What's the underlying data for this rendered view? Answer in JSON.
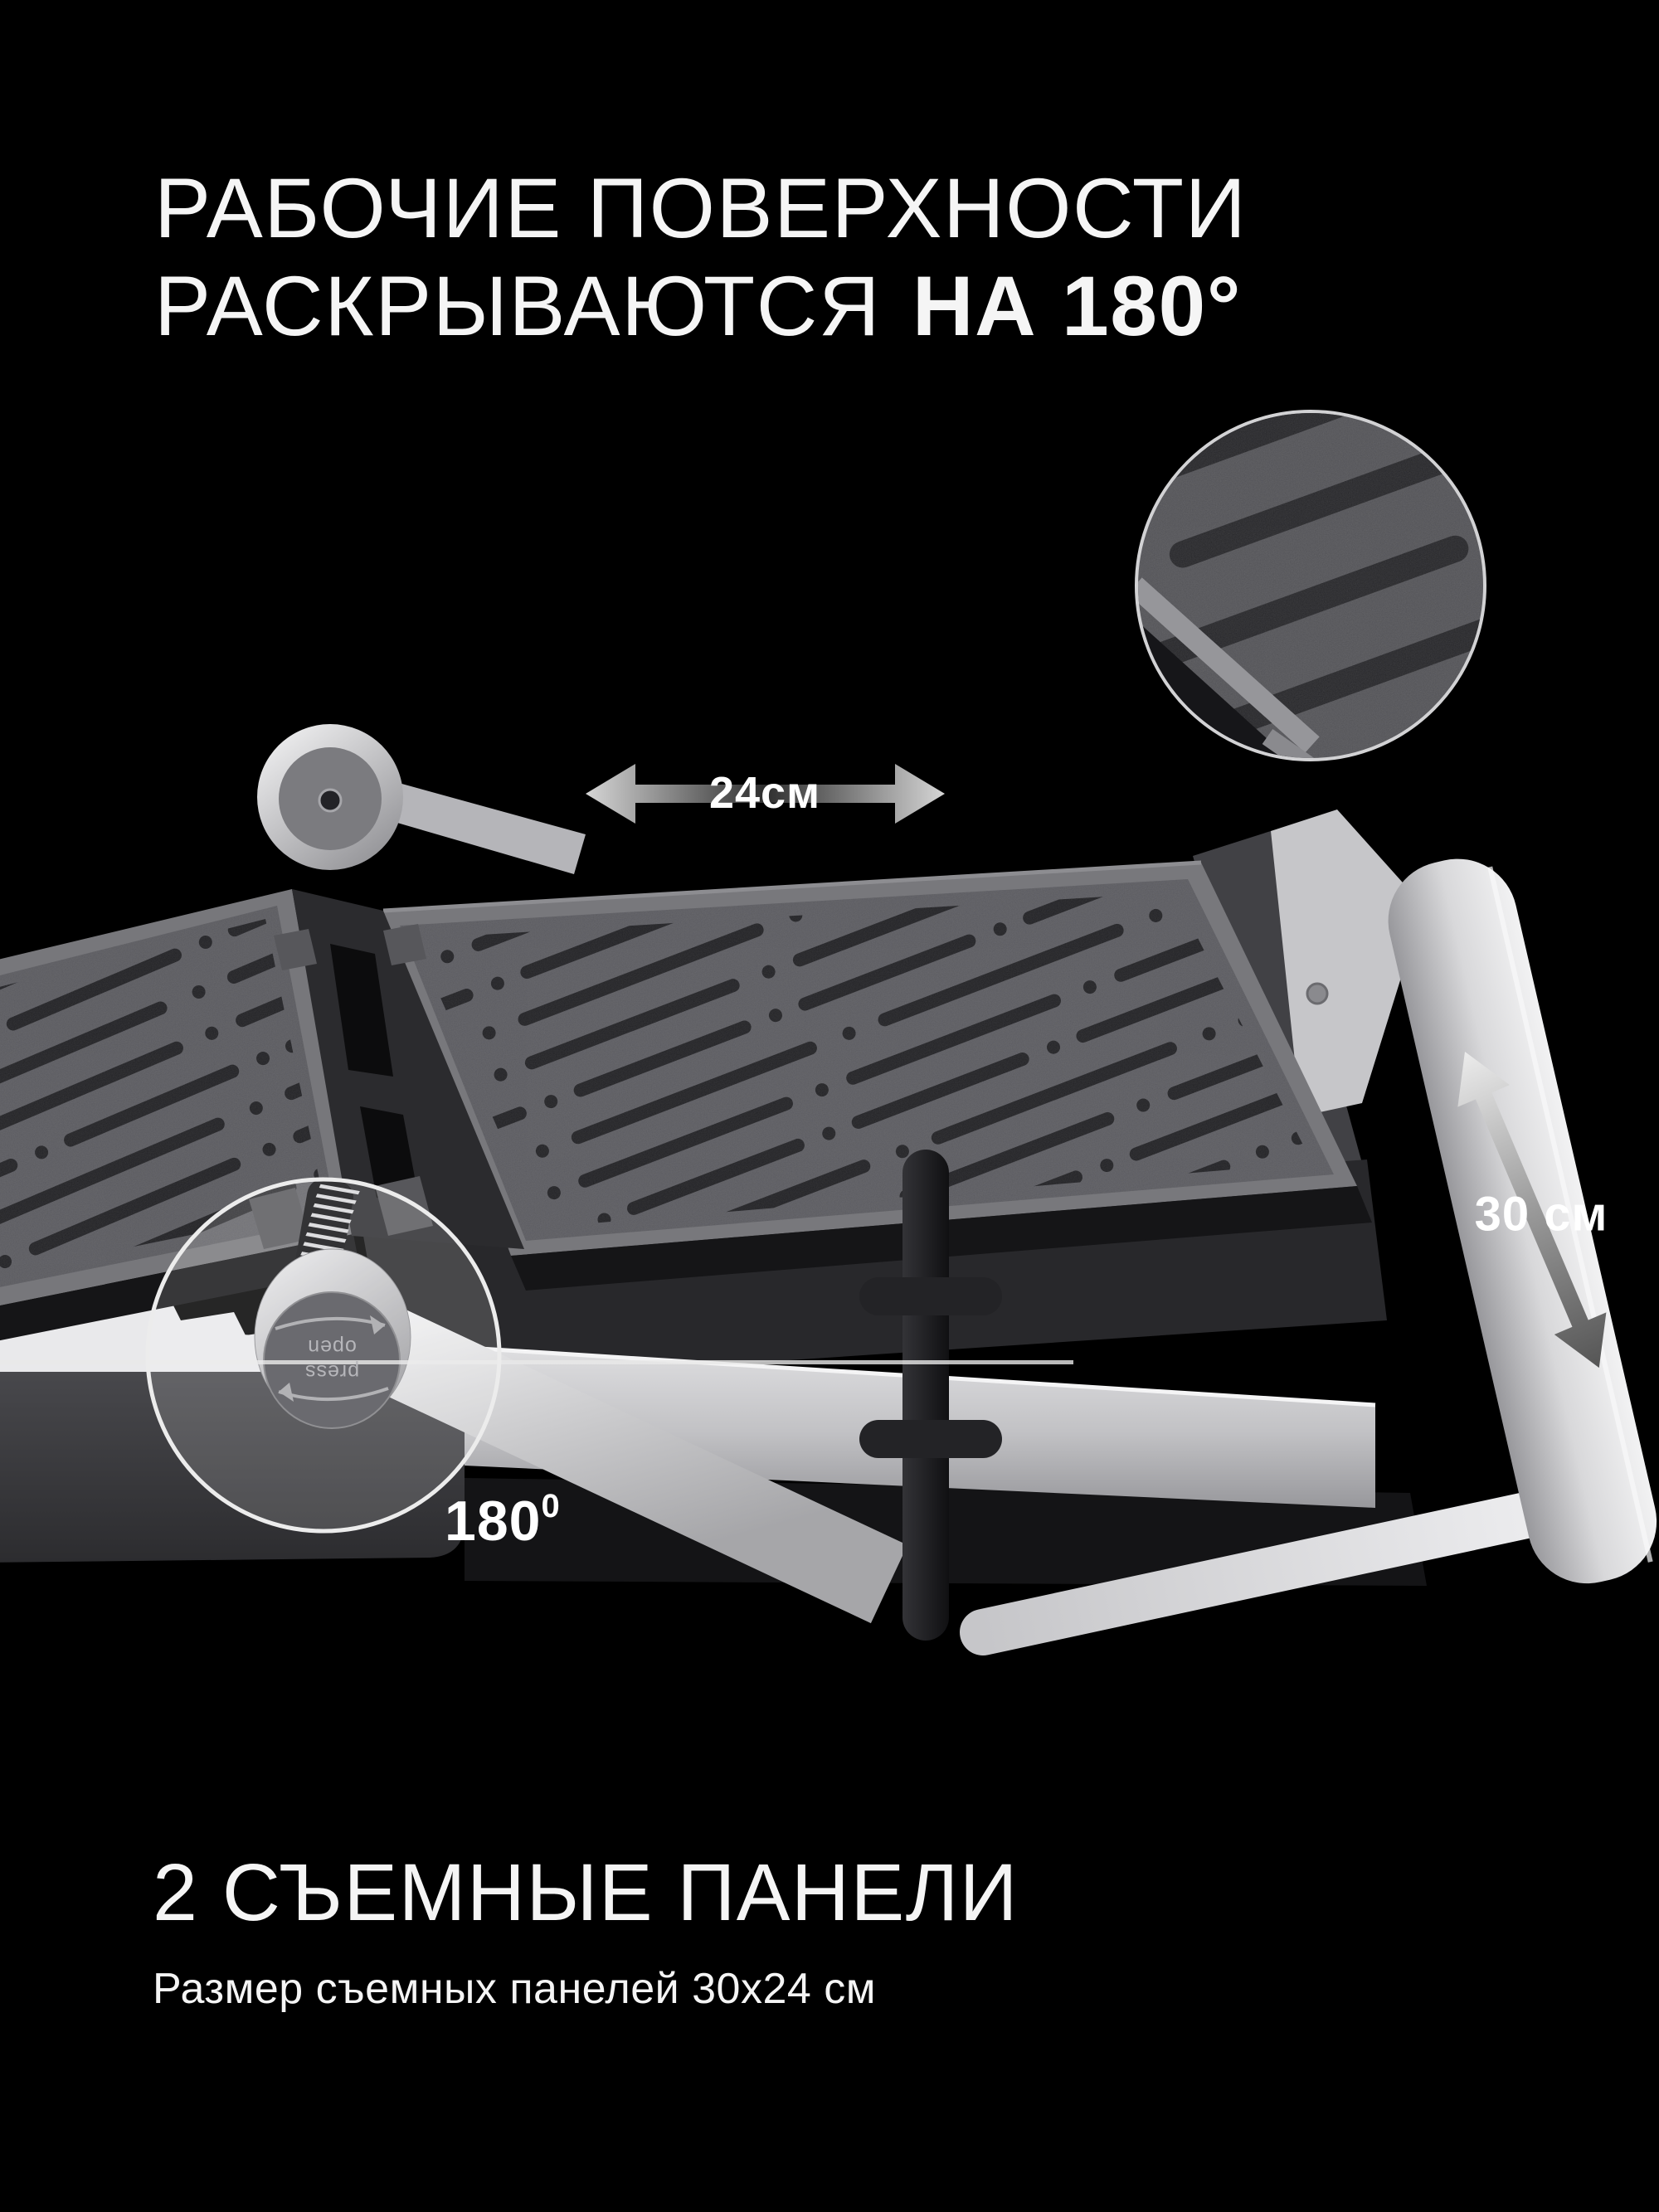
{
  "hero": {
    "title_line1": "РАБОЧИЕ ПОВЕРХНОСТИ",
    "title_line2_regular": "РАСКРЫВАЮТСЯ",
    "title_line2_bold": "НА 180°"
  },
  "annotations": {
    "width_label": "24см",
    "height_label": "30 см",
    "angle_value": "180",
    "angle_sup": "0",
    "dial_line1": "press",
    "dial_line2": "open"
  },
  "footer": {
    "heading": "2 СЪЕМНЫЕ ПАНЕЛИ",
    "subtitle": "Размер съемных панелей 30х24 см"
  },
  "colors": {
    "background": "#000000",
    "text": "#f5f5f5",
    "highlight_ring": "#ececec",
    "inset_border": "#d2d2d4",
    "plate_surface": "#56565b",
    "plate_groove": "#1b1b1e",
    "silver": "#d9d9db",
    "arrow_light": "#d6d6d6",
    "arrow_dark": "#2e2e2e"
  }
}
